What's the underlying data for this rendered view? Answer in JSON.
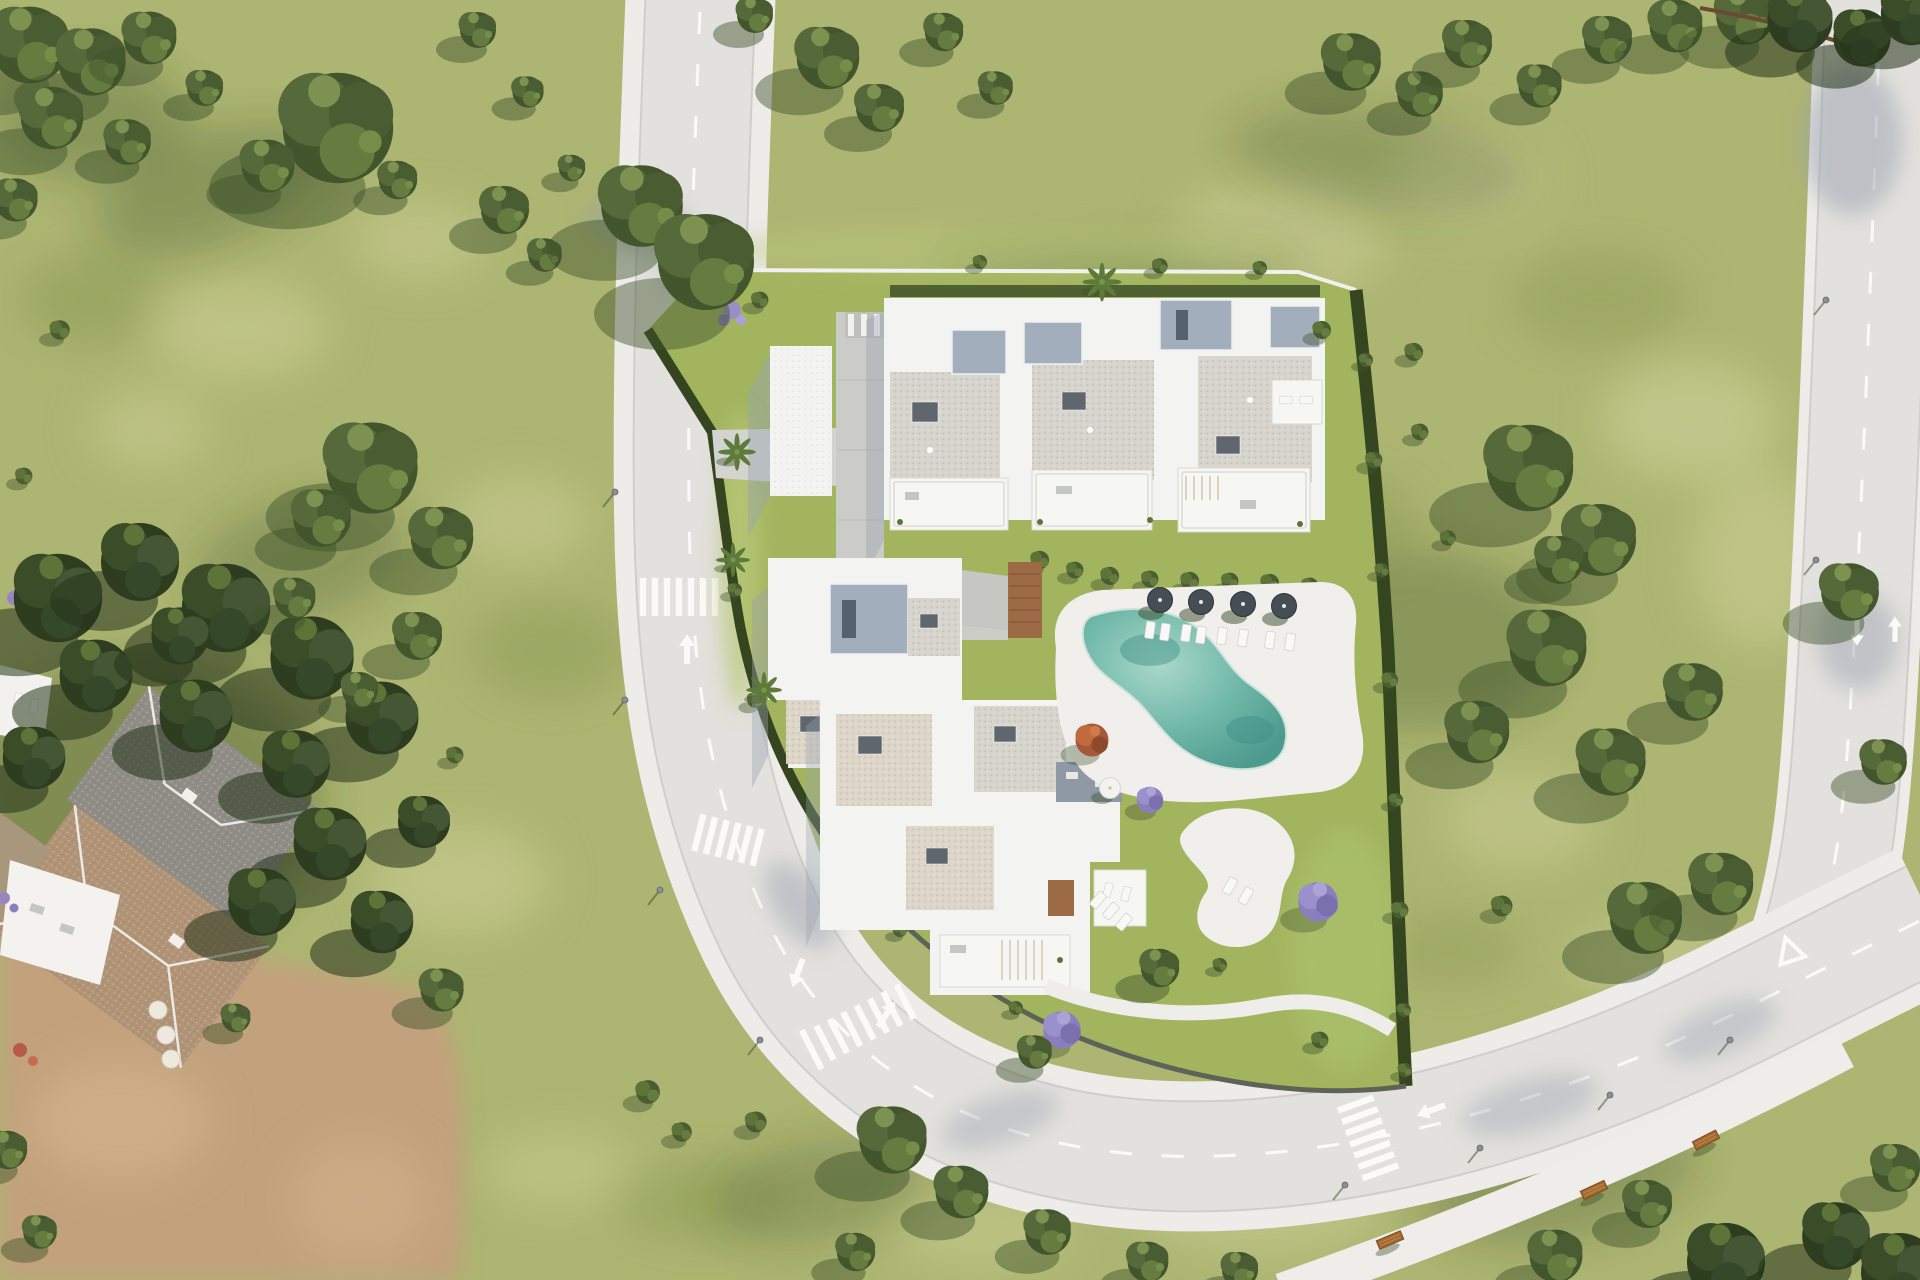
{
  "palette": {
    "grass_base": "#adb572",
    "grass_light": "#cdd097",
    "grass_dark": "#88984f",
    "complex_lawn": "#a3b45f",
    "tree_dark": "#3e5129",
    "tree_mid": "#55693a",
    "tree_light": "#7d9150",
    "hedge": "#34451f",
    "road_asphalt": "#e2e1dd",
    "road_sidewalk": "#edece9",
    "road_marking": "#fafaf8",
    "building_white": "#f3f3f1",
    "roof_gray": "#d7d4ce",
    "roof_beige": "#dcd5c8",
    "penthouse_blue": "#a3aebd",
    "roof_dark": "#5f666e",
    "deck_white": "#f0efeb",
    "pool_water_light": "#9dd2c3",
    "pool_water_deep": "#4e9a8e",
    "wood": "#9c6a45",
    "dirt": "#c2a17d",
    "villa_roof_gray": "#8f8d85",
    "villa_roof_tan": "#b19376",
    "jacaranda_purple": "#9187c0",
    "orange_tree": "#c06a3e",
    "bench_wood": "#a4692f"
  },
  "scene": {
    "setting": "aerial-view-residential-development",
    "roads": {
      "main_road": {
        "crosswalks": 3,
        "lane_arrows": 3,
        "center_line": "dashed"
      },
      "right_road": {
        "crosswalks": 0,
        "lane_arrows": 2,
        "yield_triangle": 1,
        "center_line": "dashed"
      },
      "footpath": {
        "benches": 3,
        "street_lamps": 5
      }
    },
    "residential_complex": {
      "buildings": 4,
      "swimming_pool": {
        "shape": "kidney",
        "parasols": 4,
        "sun_loungers": 8
      },
      "garden": {
        "palm_trees": 4,
        "jacaranda_trees": 3,
        "orange_trees": 1,
        "white_patio": 1,
        "garden_parasol": 1
      }
    },
    "villa": {
      "terrace_parasols": 3,
      "roof_sections": 3
    },
    "vegetation": {
      "scattered_trees": true,
      "perimeter_hedges": true
    }
  }
}
